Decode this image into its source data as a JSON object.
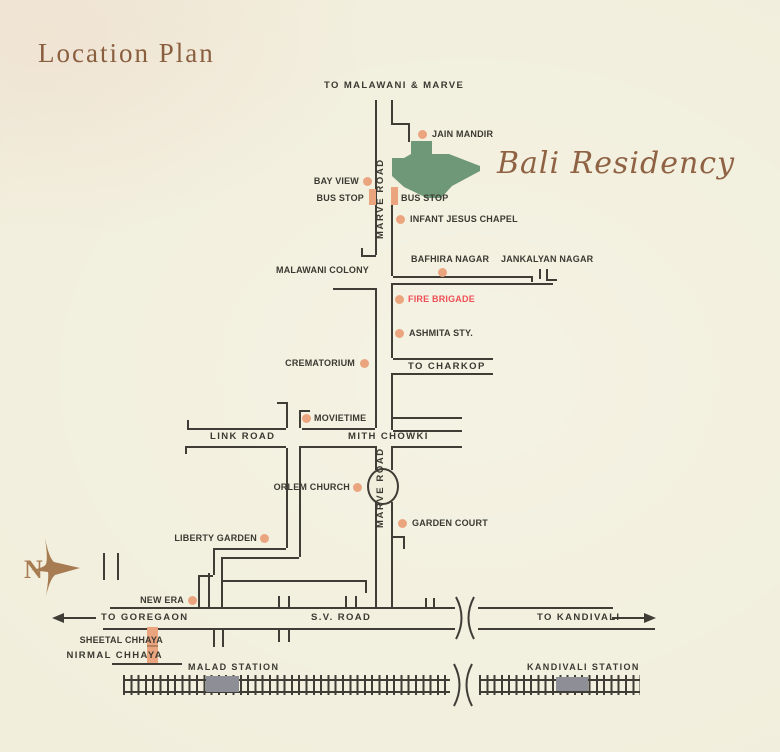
{
  "title": "Location Plan",
  "project": "Bali Residency",
  "compass": {
    "north_label": "N"
  },
  "colors": {
    "background": "#f1eedc",
    "road_line": "#3f3d36",
    "site_green": "#6e9878",
    "marker_tan": "#eba57e",
    "fire_red": "#ef5058",
    "station_gray": "#8e8e96",
    "brand_brown": "#8f6244"
  },
  "directions": {
    "to_malawani": "TO MALAWANI & MARVE",
    "to_charkop": "TO CHARKOP",
    "to_goregaon": "TO GOREGAON",
    "to_kandivali": "TO KANDIVALI"
  },
  "roads": {
    "marve_road_upper": "MARVE ROAD",
    "marve_road_lower": "MARVE ROAD",
    "link_road": "LINK ROAD",
    "mith_chowki": "MITH CHOWKI",
    "sv_road": "S.V. ROAD"
  },
  "landmarks": {
    "jain_mandir": "JAIN MANDIR",
    "bay_view": "BAY VIEW",
    "bus_stop_west": "BUS STOP",
    "bus_stop_east": "BUS STOP",
    "infant_jesus": "INFANT JESUS CHAPEL",
    "malawani_colony": "MALAWANI COLONY",
    "bafhira_nagar": "BAFHIRA NAGAR",
    "jankalyan_nagar": "JANKALYAN NAGAR",
    "fire_brigade": "FIRE BRIGADE",
    "ashmita": "ASHMITA STY.",
    "crematorium": "CREMATORIUM",
    "movietime": "MOVIETIME",
    "orlem_church": "ORLEM CHURCH",
    "garden_court": "GARDEN COURT",
    "liberty_garden": "LIBERTY GARDEN",
    "new_era": "NEW ERA",
    "sheetal_chhaya": "SHEETAL CHHAYA",
    "nirmal_chhaya": "NIRMAL CHHAYA"
  },
  "stations": {
    "malad": "MALAD STATION",
    "kandivali": "KANDIVALI STATION"
  }
}
